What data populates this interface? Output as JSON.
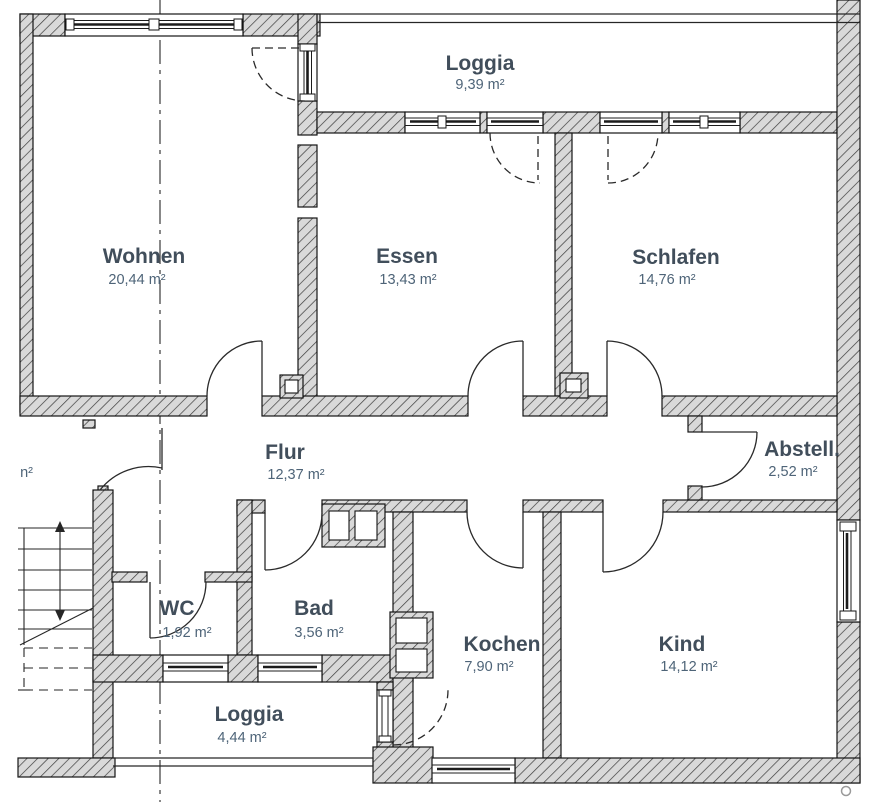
{
  "plan": {
    "title": "apartment-floor-plan",
    "rooms": [
      {
        "name": "Loggia",
        "area": "9,39 m²"
      },
      {
        "name": "Wohnen",
        "area": "20,44 m²"
      },
      {
        "name": "Essen",
        "area": "13,43 m²"
      },
      {
        "name": "Schlafen",
        "area": "14,76 m²"
      },
      {
        "name": "Flur",
        "area": "12,37 m²"
      },
      {
        "name": "Abstell.",
        "area": "2,52 m²"
      },
      {
        "name": "WC",
        "area": "1,92 m²"
      },
      {
        "name": "Bad",
        "area": "3,56 m²"
      },
      {
        "name": "Kochen",
        "area": "7,90 m²"
      },
      {
        "name": "Kind",
        "area": "14,12 m²"
      },
      {
        "name": "Loggia",
        "area": "4,44 m²"
      }
    ],
    "cropped_label": "n²",
    "colors": {
      "room_name": "#414e5b",
      "room_area": "#4e6478",
      "wall_fill": "#d9d9d9",
      "wall_hatch": "#3c3c3c",
      "line": "#141414",
      "background": "#ffffff"
    }
  }
}
